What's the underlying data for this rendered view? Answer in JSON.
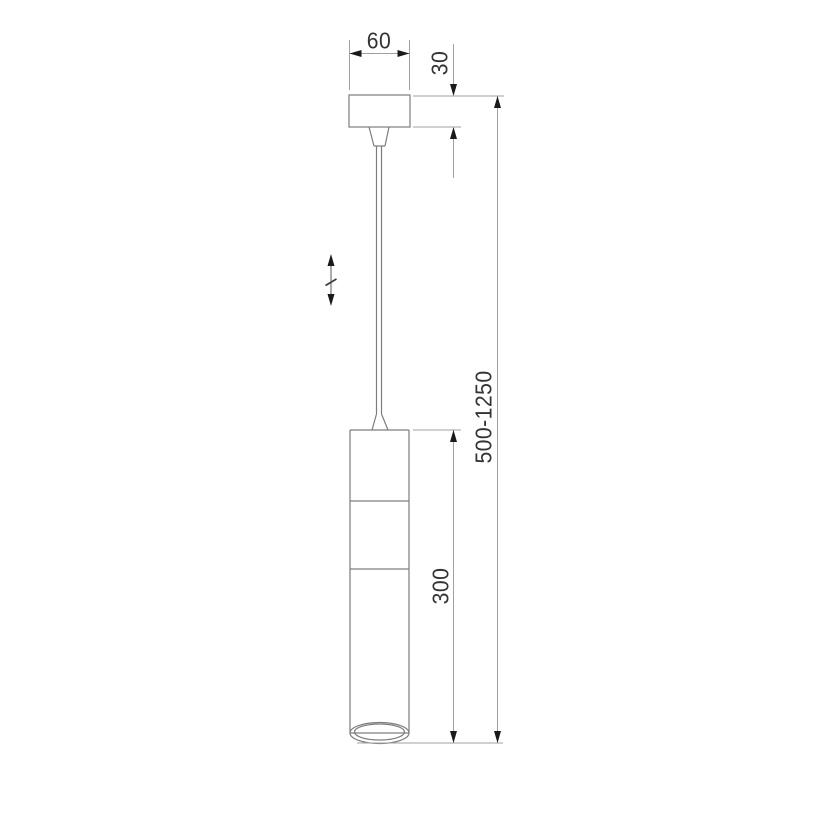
{
  "drawing": {
    "type": "technical-dimension-drawing",
    "subject": "pendant-lamp",
    "dimensions": {
      "canopy_width": "60",
      "canopy_height": "30",
      "body_height": "300",
      "overall_height": "500-1250"
    },
    "icons": {
      "adjustable_height": "double-arrow-with-break-icon"
    },
    "colors": {
      "background": "#ffffff",
      "product_line": "#7d7d7d",
      "dimension_line": "#a0a0a0",
      "arrow": "#1a1a1a",
      "text": "#333333"
    }
  }
}
